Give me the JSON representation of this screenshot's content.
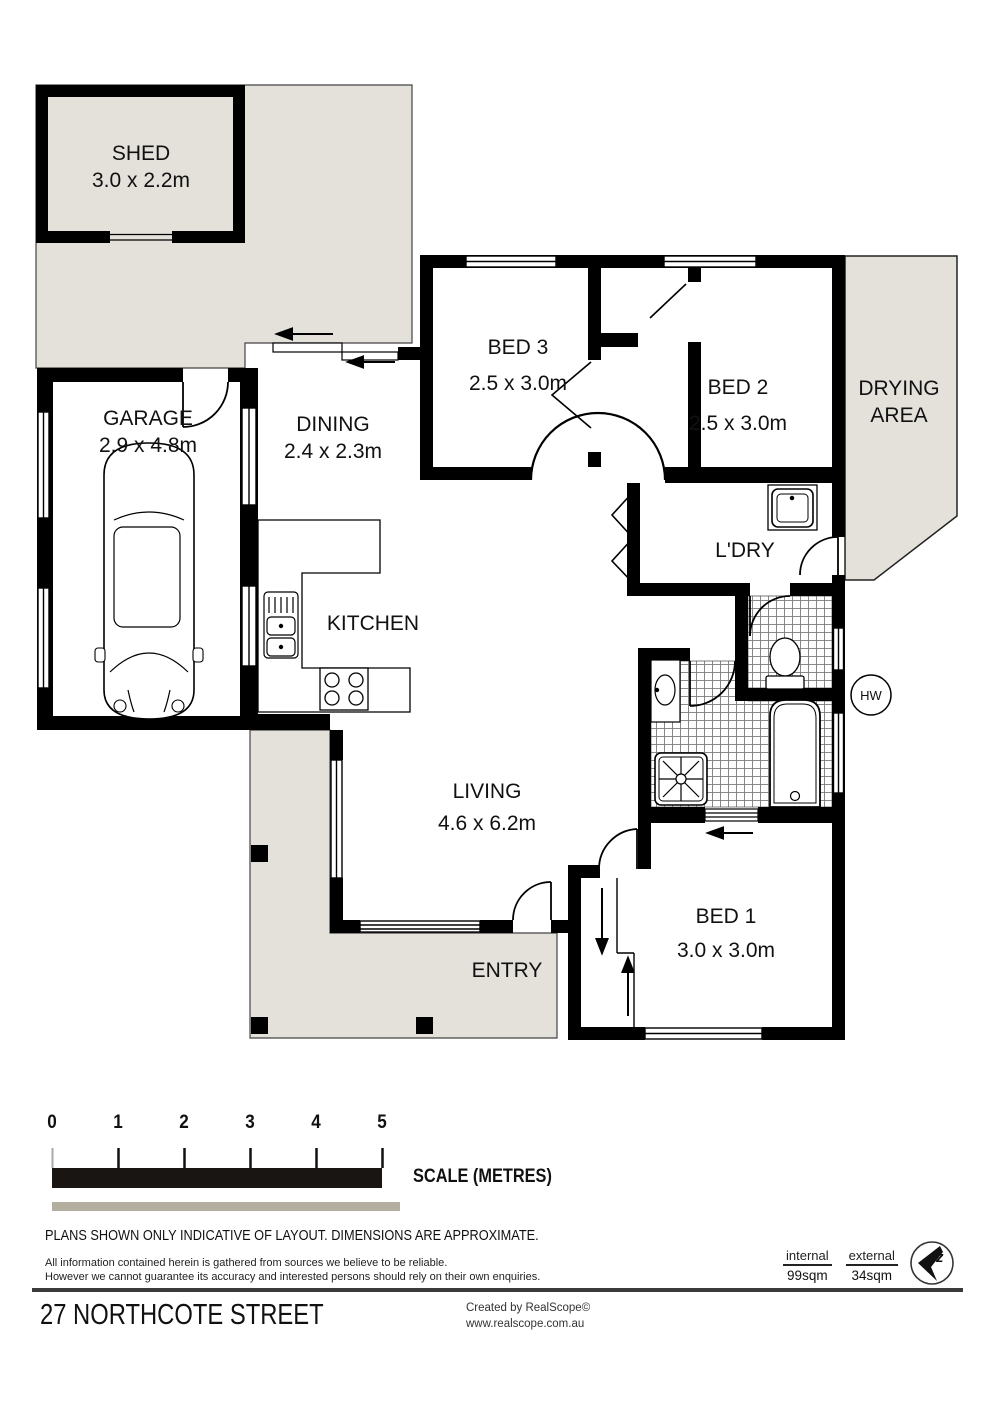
{
  "plan": {
    "rooms": {
      "shed": {
        "name": "SHED",
        "dims": "3.0 x 2.2m"
      },
      "garage": {
        "name": "GARAGE",
        "dims": "2.9 x 4.8m"
      },
      "dining": {
        "name": "DINING",
        "dims": "2.4 x 2.3m"
      },
      "bed3": {
        "name": "BED 3",
        "dims": "2.5 x 3.0m"
      },
      "bed2": {
        "name": "BED 2",
        "dims": "2.5 x 3.0m"
      },
      "bed1": {
        "name": "BED 1",
        "dims": "3.0 x 3.0m"
      },
      "living": {
        "name": "LIVING",
        "dims": "4.6 x 6.2m"
      },
      "kitchen": {
        "name": "KITCHEN"
      },
      "laundry": {
        "name": "L'DRY"
      },
      "entry": {
        "name": "ENTRY"
      },
      "drying": {
        "line1": "DRYING",
        "line2": "AREA"
      },
      "hot_water": {
        "abbr": "HW"
      }
    },
    "colors": {
      "outdoor_grey": "#e4e1db",
      "wall_black": "#000000",
      "scale_bar_grey": "#b3ae9f"
    }
  },
  "scale_bar": {
    "ticks": [
      "0",
      "1",
      "2",
      "3",
      "4",
      "5"
    ],
    "caption": "SCALE (METRES)"
  },
  "notes": {
    "plans": "PLANS SHOWN ONLY INDICATIVE OF LAYOUT.  DIMENSIONS ARE APPROXIMATE.",
    "disclaimer1": "All information contained herein is gathered from sources we believe to be reliable.",
    "disclaimer2": "However we cannot guarantee its accuracy and interested persons should rely on their own enquiries."
  },
  "areas": {
    "internal_label": "internal",
    "internal_value": "99sqm",
    "external_label": "external",
    "external_value": "34sqm"
  },
  "footer": {
    "address": "27 NORTHCOTE STREET",
    "credit_line1": "Created by RealScope©",
    "credit_line2": "www.realscope.com.au"
  }
}
